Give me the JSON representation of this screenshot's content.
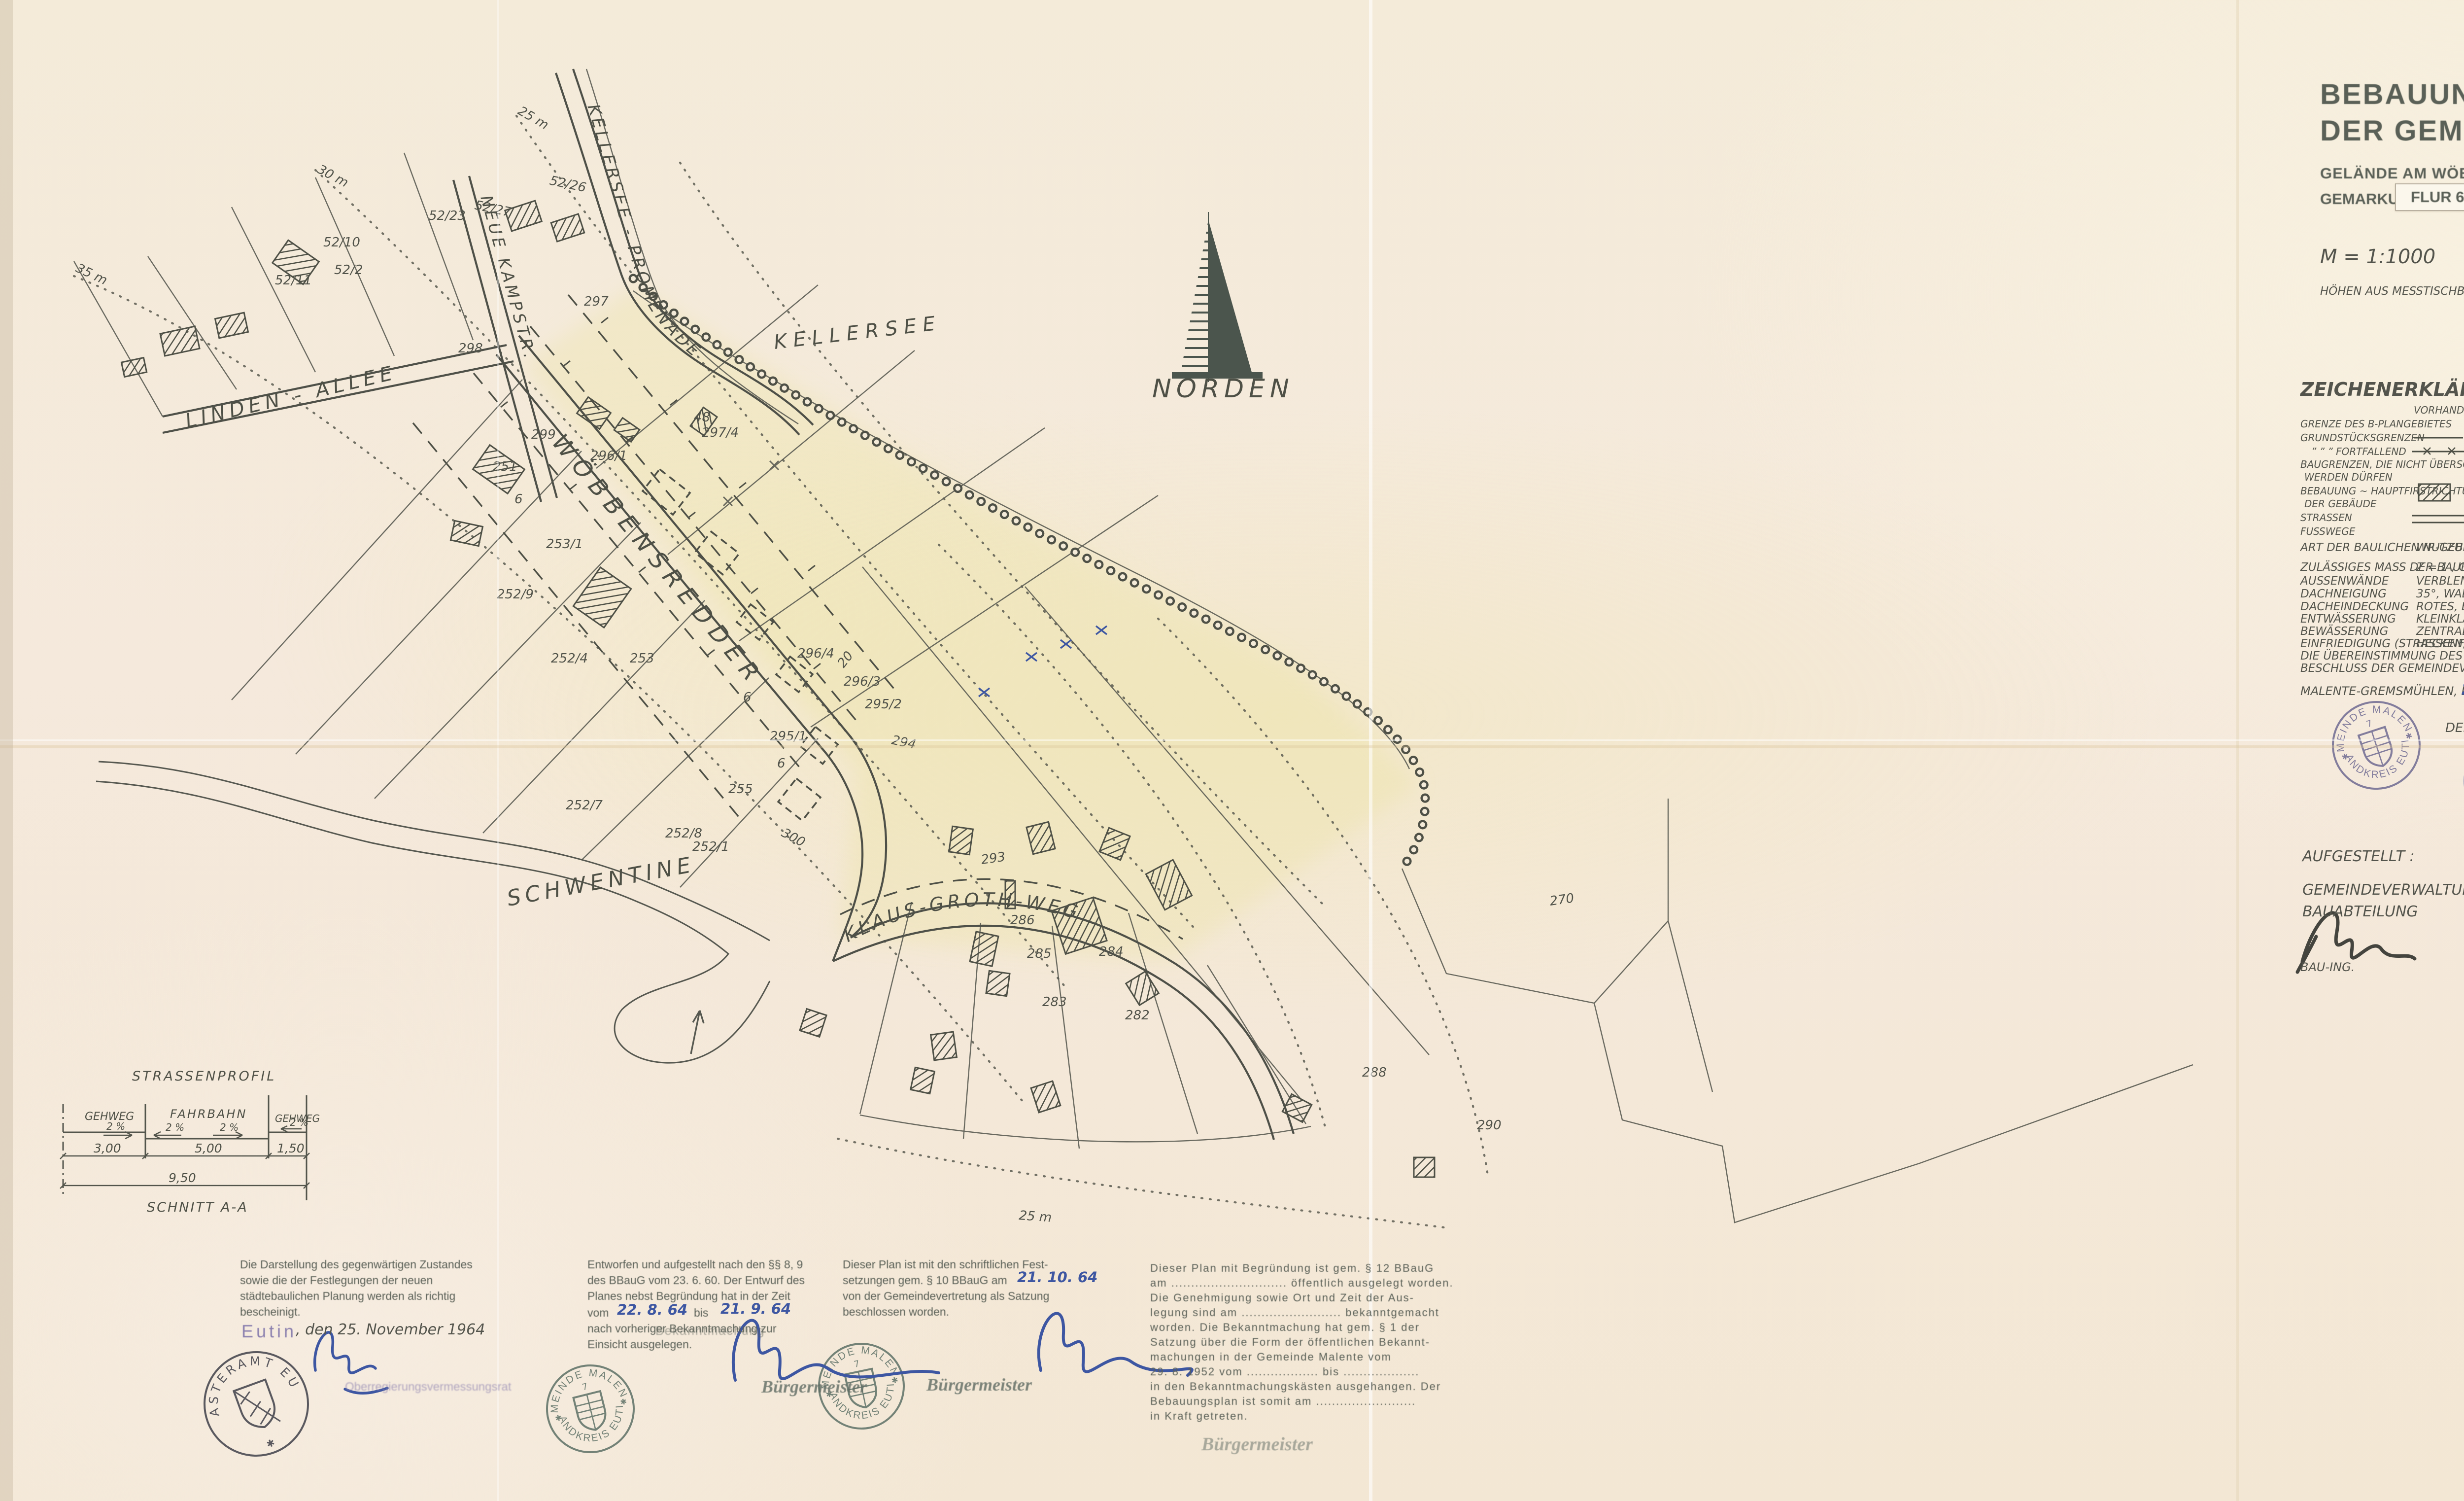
{
  "sheet": {
    "page_mark": "2"
  },
  "title_block": {
    "line1": "BEBAUUNGSPLAN NR. 8",
    "line2": "DER GEMEINDE MALENTE",
    "subtitle": "GELÄNDE AM WÖBBENSREDDER (GRUNDSTÜCK HINRICHS)",
    "gemarkung": "GEMARKUNG MALENTE,",
    "flur": "FLUR 6",
    "scale": "M = 1:1000",
    "note": "HÖHEN AUS MESSTISCHBLATT  1 : 25000"
  },
  "legend": {
    "heading": "ZEICHENERKLÄRUNG :",
    "col_existing": "VORHANDEN",
    "col_planned": "GEPLANT",
    "row1": "GRENZE DES B-PLANGEBIETES",
    "row2": "GRUNDSTÜCKSGRENZEN",
    "row3": "”   ”   ”    FORTFALLEND",
    "row4a": "BAUGRENZEN, DIE NICHT ÜBERSCHRITTEN",
    "row4b": "WERDEN DÜRFEN",
    "row5a": "BEBAUUNG ~ HAUPTFIRSTRICHTUNG",
    "row5b": "DER GEBÄUDE",
    "row6": "STRASSEN",
    "row7": "FUSSWEGE"
  },
  "nutzung": {
    "art_label": "ART DER BAULICHEN NUTZUNG :",
    "art_value": "WR-GEBIET GEM. § 3 BAUNUTZUNGSVERORDNG.  26.6.62.",
    "mass_label": "ZULÄSSIGES MASS DER BAULICHEN NUTZUNG",
    "mass_value": "Z = 1 ,  GRZ = 0,4 ,  GFZ = 0,4 .",
    "wand_label": "AUSSENWÄNDE",
    "wand_value": "VERBLENDBAUWEISE, TEILE VERPUTZT BZW. HOLZ",
    "neig_label": "DACHNEIGUNG",
    "neig_value": "35°,  WALMDÄCHER ZUGELASSEN",
    "deck_label": "DACHEINDECKUNG",
    "deck_value": "ROTES, BRAUNES OD. SCHWARZES PFANNENDACH",
    "entw_label": "ENTWÄSSERUNG",
    "entw_value": "KLEINKLÄRANLAGEN NACH DIN 4261 M. U-GRUNDVER-",
    "bew_label": "BEWÄSSERUNG",
    "bew_value": "ZENTRALE WASSERVERSORGUNG",
    "sickerung": "SICKERUNG.",
    "einf_label": "EINFRIEDIGUNG (STRASSENFRONT)",
    "einf_value": "HECKEN, SPRIEGEL- OD. LATTENZÄUNE, MAUERN",
    "attest1": "DIE ÜBEREINSTIMMUNG DES PLANES UND DES TEXTTEILES MIT DEM SATZUNGS-",
    "attest2": "BESCHLUSS DER GEMEINDEVERTRETUNG VOM",
    "attest3": "WIRD HIERMIT BEGLAUBIGT .",
    "place_label": "MALENTE-GREMSMÜHLEN, DEM",
    "place_date": "21. 10. 64",
    "mayor": "DER BÜRGERMEISTER"
  },
  "aufgestellt": {
    "heading": "AUFGESTELLT :",
    "line1": "GEMEINDEVERWALTUNG MALENTE",
    "line2": "BAUABTEILUNG",
    "signer_title": "BAU-ING."
  },
  "approval": {
    "title": "GENEHMIGT",
    "subtitle": "GEMÄSS ERLASS",
    "ref_prefix": "IX",
    "ref_hw": "Wb - 113/64 - 03.06 (8)",
    "vom_label": "VOM",
    "vom_hw": "5. Febr.",
    "year_prefix": "19",
    "vom_year_hw": "65",
    "kiel_label": "KIEL, DEN",
    "kiel_hw": "5. Febr.",
    "kiel_year_hw": "65",
    "minister1": "Der Minister",
    "minister2": "für Arbeit, Soziales und Vertriebene",
    "minister3": "des Landes Schleswig-Holstein",
    "sig_name": "(Dr. Otto)"
  },
  "cert1": {
    "l1": "Die Darstellung des gegenwärtigen Zustandes",
    "l2": "sowie die der Festlegungen der neuen",
    "l3": "städtebaulichen Planung werden als richtig",
    "l4": "bescheinigt.",
    "place": "Eutin",
    "date": ", den 25. November 1964",
    "officer": "Oberregierungsvermessungsrat"
  },
  "cert2": {
    "l1": "Entworfen und aufgestellt nach den §§ 8, 9",
    "l2": "des BBauG vom 23. 6. 60. Der Entwurf des",
    "l3": "Planes nebst Begründung hat in der Zeit",
    "vom": "vom",
    "from": "22. 8. 64",
    "bis": "bis",
    "to": "21. 9. 64",
    "l4": "nach vorheriger Bekanntmachung zur",
    "l5": "Einsicht ausgelegen.",
    "overlay": "Bekanntmachung",
    "titlestamp": "Bürgermeister"
  },
  "cert3": {
    "l1": "Dieser Plan ist mit den schriftlichen Fest-",
    "l2pre": "setzungen gem. § 10 BBauG am",
    "date": "21. 10. 64",
    "l3": "von der Gemeindevertretung als Satzung",
    "l4": "beschlossen worden.",
    "titlestamp": "Bürgermeister"
  },
  "cert4": {
    "l1": "Dieser Plan mit Begründung ist gem. § 12 BBauG",
    "l2": "am ............................. öffentlich ausgelegt worden.",
    "l3": "Die Genehmigung sowie Ort und Zeit der Aus-",
    "l4": "legung sind am ......................... bekanntgemacht",
    "l5": "worden. Die Bekanntmachung hat gem. § 1 der",
    "l6": "Satzung über die Form der öffentlichen Bekannt-",
    "l7": "machungen in der Gemeinde Malente vom",
    "l8": "29. 8. 1952 vom .................. bis ...................",
    "l9": "in den Bekanntmachungskästen ausgehangen. Der",
    "l10": "Bebauungsplan ist somit am .........................",
    "l11": "in Kraft getreten.",
    "footer": "Bürgermeister"
  },
  "profile": {
    "title": "STRASSENPROFIL",
    "gehweg_left": "GEHWEG",
    "fahrbahn": "FAHRBAHN",
    "gehweg_right": "GEHWEG",
    "slope1": "2 %",
    "slope2": "2 %",
    "slope3": "2 %",
    "slope4": "2 %",
    "dim_left": "3,00",
    "dim_center": "5,00",
    "dim_right": "1,50",
    "dim_total": "9,50",
    "section": "SCHNITT A-A"
  },
  "seals": {
    "gemeinde_top": "GEMEINDE MALENTE",
    "gemeinde_bottom": "LANDKREIS EUTIN",
    "gemeinde_number": "7",
    "kataster_top": "KATASTERAMT EUTIN",
    "minister_top": "DER MINISTER FÜR ARBEIT",
    "minister_bottom": "SOZIALES UND VERTRIEBENE",
    "minister_inner": "DES LANDES SCHLESWIG-HOLSTEIN",
    "star": "✱"
  },
  "map": {
    "labels": {
      "lake": "KELLERSEE",
      "north": "NORDEN",
      "promenade": "KELLERSEE - PROMENADE",
      "kampstr": "NEUE KAMPSTR.",
      "allee": "LINDEN - ALLEE",
      "redder": "WÖBBENSREDDER",
      "grothweg": "KLAUS-GROTH-WEG",
      "river": "SCHWENTINE"
    },
    "contours": [
      "25 m",
      "30 m",
      "35 m",
      "25 m"
    ],
    "parcels": [
      "251",
      "299",
      "297",
      "296/1",
      "48",
      "297/4",
      "253/1",
      "252/9",
      "252/4",
      "253",
      "296/4",
      "296/3",
      "295/2",
      "295/1",
      "294",
      "255",
      "300",
      "252/7",
      "252/8",
      "252/1",
      "293",
      "286",
      "285",
      "284",
      "283",
      "282",
      "270",
      "288",
      "290",
      "52/10",
      "52/2",
      "52/11",
      "52/23",
      "52/27",
      "52/26",
      "298",
      "20",
      "6",
      "6",
      "6"
    ]
  }
}
